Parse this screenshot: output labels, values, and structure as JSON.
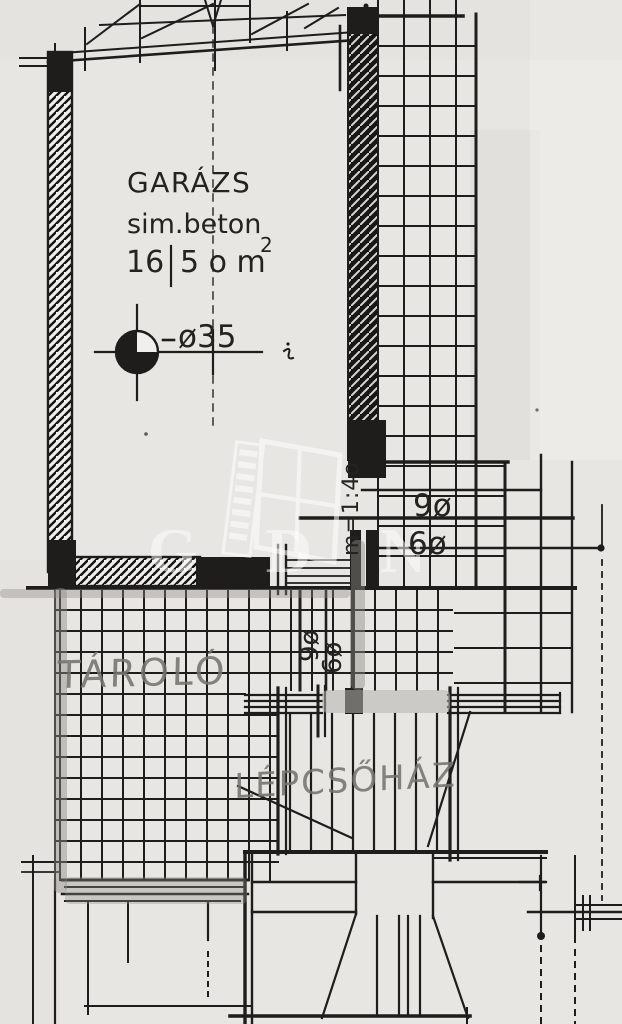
{
  "colors": {
    "paper": "#e8e6e2",
    "ink": "#1e1d1b",
    "pencil": "#76746f",
    "marker": "#8d8b86",
    "watermark": "#ffffff"
  },
  "garage": {
    "name": "GARÁZS",
    "material": "sim.beton",
    "area_whole": "16",
    "area_rest": "5 o m",
    "area_exponent": "2",
    "column_dimension": "ø35"
  },
  "annotations": {
    "scale_vertical": "m=1:4o",
    "steps_9": "9ø",
    "steps_6": "6ø",
    "steps_9_side": "9ø",
    "steps_6_side": "6ø"
  },
  "rooms": {
    "storage": "TÁROLÓ",
    "staircase": "LÉPCSŐHÁZ"
  },
  "watermark": {
    "letters": "G D N"
  }
}
